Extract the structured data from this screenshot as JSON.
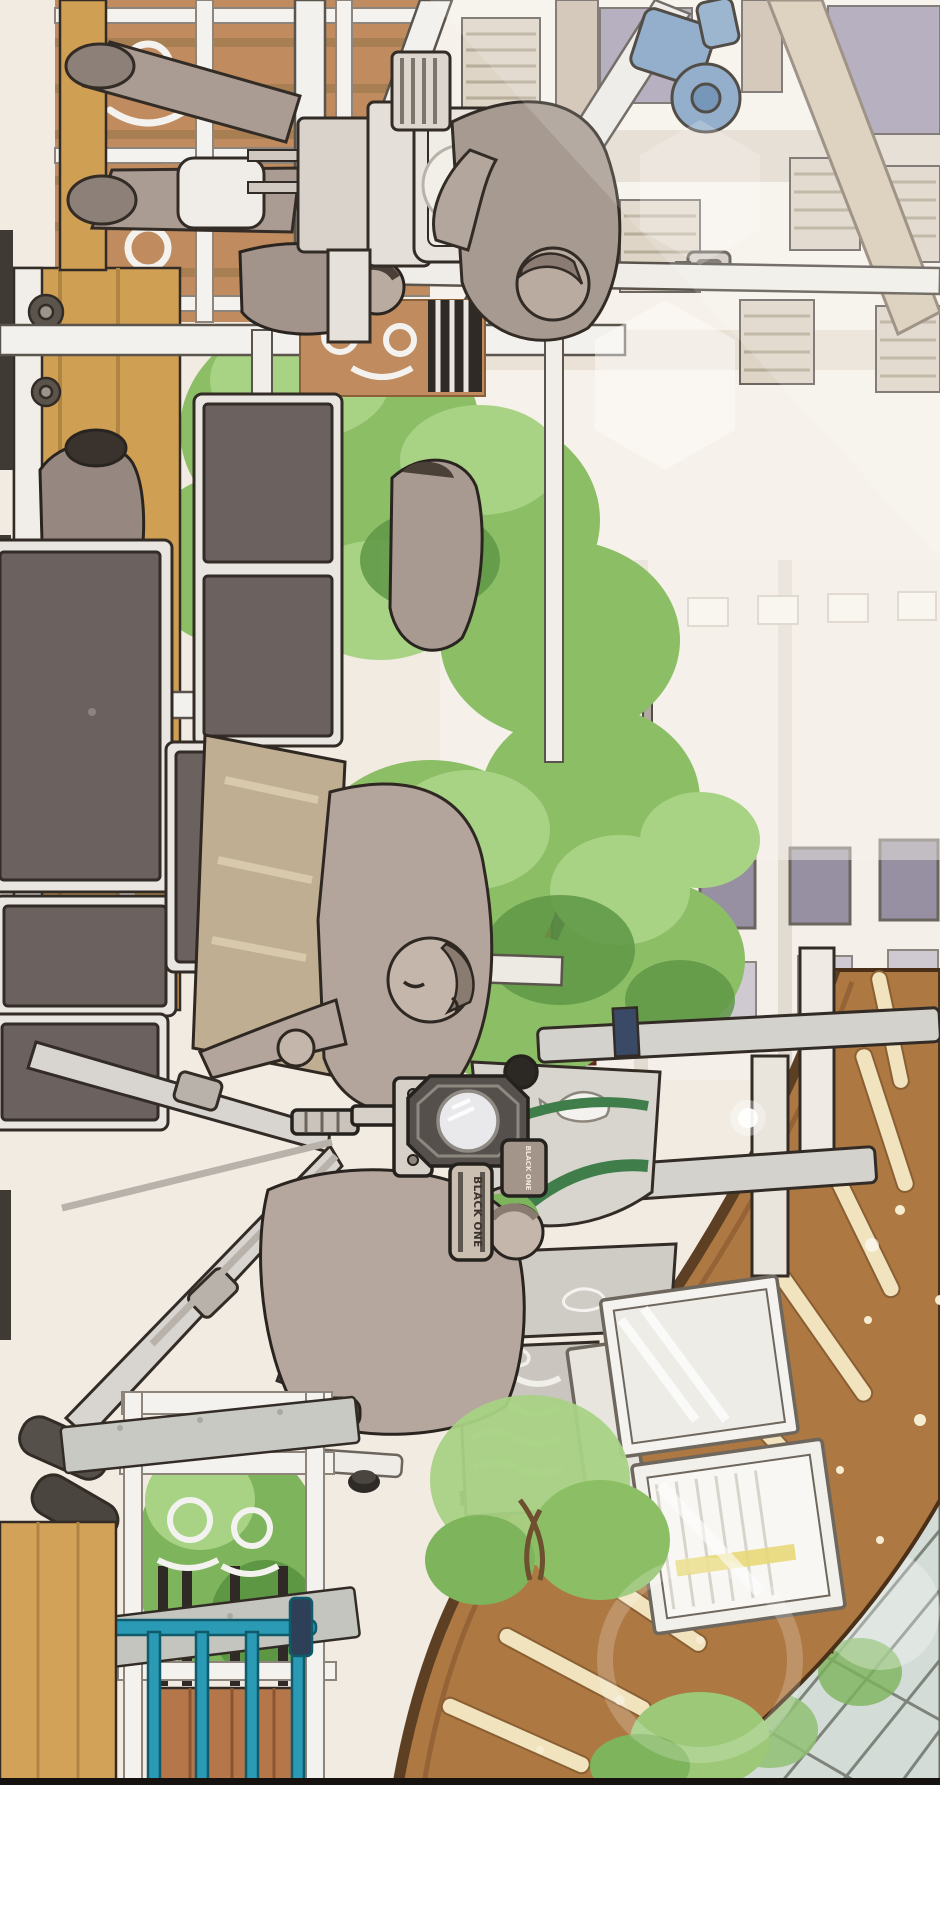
{
  "artwork": {
    "format": "vertical webtoon comic panel, entire scene drawn rotated 90 degrees (landscape scene laid on its side)",
    "scene_description": "Overhead view of a film/drama crew shooting in an apartment-complex playground plaza. A large cinema camera on a crane rig with an operator sits at the top, black flag reflector panels on C-stands fill the left side, a script supervisor holds a board, and a second operator crouches behind a BLACK ONE branded camera with a shotgun mic on a tripod. Around them: green trees, a cream apartment facade with louvered windows, a whale-motif playground bench, a curved brown wooden bridge deck with slat openings, a glass notice board, an ornate white fence over wood planks, a teal pipe railing and a tan timber deck. Lens-flare glows wash the upper right. The panel ends in a black rule with white paper below.",
    "labels": {
      "camera_brand": "BLACK ONE"
    },
    "figures": [
      {
        "role": "crane camera operator",
        "position": "top, leaning over the cinema camera, wearing a cap"
      },
      {
        "role": "crew member standing on dolly platform",
        "position": "top left, only legs and shoes visible"
      },
      {
        "role": "crew member walking",
        "position": "upper middle, seen from behind"
      },
      {
        "role": "crew member in dark cap by flag panels",
        "position": "middle left, crouched"
      },
      {
        "role": "script supervisor holding reflector board",
        "position": "center, eyes closed, leaning forward"
      },
      {
        "role": "camera operator crouching",
        "position": "lower center, gripping the BLACK ONE camera handle"
      }
    ],
    "equipment": [
      "cinema camera with matte box on crane dolly",
      "blue scaffold clamps",
      "black flag reflector panels in white frames",
      "red C-stand pole",
      "BLACK ONE video camera with octagonal lens cage",
      "shotgun microphone with windscreen ball",
      "silver tripod with telescoping legs",
      "tan reflector board"
    ],
    "setting": [
      "cream apartment facade with louvered shutters and lavender windows",
      "hazy second facade with window rows",
      "street lamp",
      "security camera",
      "green trees and shrubs",
      "red brick tower with dark window",
      "whale-motif gray playground bench with green trim",
      "wavy-line gray play panel",
      "glass tri-fold notice board",
      "curved brown bridge deck with cream slats and sparkle flecks",
      "colored tile strip on bridge edge",
      "glass curtain-wall building corner",
      "brick pillar",
      "ornate white iron fence over brown planks",
      "teal pipe railing",
      "tan timber deck with caster wheels",
      "gray speckled stone beams",
      "hexagonal lens flare and light glows"
    ],
    "palette": {
      "paper_white": "#ffffff",
      "panel_border_black": "#15120f",
      "cream_background": "#f1ebe2",
      "wall_white": "#f6f1ea",
      "wall_band_beige": "#e3dace",
      "window_lavender": "#a8a1b5",
      "window_light": "#cfc9d2",
      "crane_beam_beige": "#d8cbb6",
      "wood_deck_tan": "#cf9f54",
      "plank_brown": "#c08c5f",
      "bridge_brown": "#ad7841",
      "bridge_rim_dark": "#5d3f24",
      "slat_cream": "#f0e3bd",
      "flag_panel_dark": "#6b625f",
      "frame_white": "#e9e5e0",
      "clothing_taupe": "#b3a49c",
      "skin_taupe": "#c4b6aa",
      "outline_ink": "#332c26",
      "foliage_green": "#8cbe66",
      "foliage_light": "#a8d284",
      "foliage_dark": "#5f9846",
      "green_trim": "#3f7d4a",
      "teal_rail": "#2b9ab4",
      "red_pole": "#c23b2c",
      "blue_clamp": "#7fa0c2",
      "navy_clamp": "#3a4a66",
      "stone_gray": "#c9c9c4",
      "glass_green": "#d3dcd6",
      "brick_red": "#a05138",
      "tile_teal": "#3fb6c9",
      "tile_blue": "#3a6fc4",
      "tile_yellow": "#ded84f"
    }
  }
}
